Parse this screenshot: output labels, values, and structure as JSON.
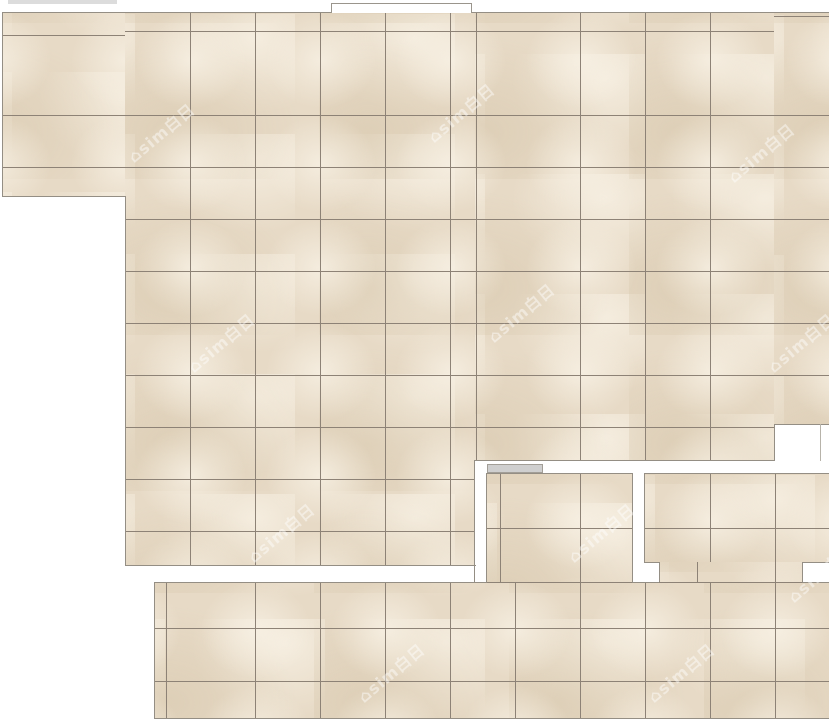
{
  "app": {
    "view_label": "tile-layout-floor-plan",
    "canvas_width": 829,
    "canvas_height": 723
  },
  "palette": {
    "background": "#ffffff",
    "tile_base": "#e7dac6",
    "grout": "#8d8276",
    "region_border": "#948e84",
    "vein_light": "rgba(247,240,227,0.85)",
    "vein_light_end": "rgba(247,240,227,0)",
    "vein_dark": "rgba(214,198,171,0.55)",
    "vein_dark_end": "rgba(214,198,171,0)",
    "threshold_fill": "#cfcfcf",
    "threshold_border": "#a29e97",
    "opening_border": "#9a958c",
    "notch_inner_line": "#b7b3aa",
    "artifact_strip": "#dcdcdc",
    "watermark_color": "rgba(255,255,255,0.45)"
  },
  "tile_spec": {
    "tile_width_px": 65,
    "tile_height_px": 52,
    "grout_px": 1
  },
  "regions": [
    {
      "id": "a1",
      "x": 2,
      "y": 13,
      "w": 123,
      "h": 184,
      "vx": 59,
      "h_pattern": "rep52",
      "hy": 51
    },
    {
      "id": "a2",
      "x": 125,
      "y": 13,
      "w": 350,
      "h": 552,
      "vx": 1,
      "h_pattern": "rep52",
      "hy": 51
    },
    {
      "id": "a3",
      "x": 475,
      "y": 13,
      "w": 299,
      "h": 448,
      "vx": 41,
      "h_pattern": "rep52",
      "hy": 51
    },
    {
      "id": "a4",
      "x": 774,
      "y": 13,
      "w": 55,
      "h": 411,
      "vx": 2,
      "h_pattern": "rep52",
      "hy": 51
    },
    {
      "id": "b",
      "x": 487,
      "y": 474,
      "w": 145,
      "h": 109,
      "vx": 29,
      "h_pattern": "line54",
      "hy": 0
    },
    {
      "id": "c1",
      "x": 645,
      "y": 474,
      "w": 184,
      "h": 88,
      "vx": 1,
      "h_pattern": "line54",
      "hy": 0
    },
    {
      "id": "c2",
      "x": 659,
      "y": 562,
      "w": 143,
      "h": 21,
      "vx": 52,
      "h_pattern": "none",
      "hy": 0
    },
    {
      "id": "d",
      "x": 155,
      "y": 583,
      "w": 674,
      "h": 136,
      "vx": 36,
      "h_pattern": "lines45_98",
      "hy": 0
    }
  ],
  "edges": [
    {
      "id": "a-top",
      "x": 2,
      "y": 12,
      "w": 827,
      "h": 1
    },
    {
      "id": "a-left",
      "x": 2,
      "y": 12,
      "w": 1,
      "h": 185
    },
    {
      "id": "wing-bottom",
      "x": 2,
      "y": 196,
      "w": 124,
      "h": 1
    },
    {
      "id": "a-left-lower",
      "x": 125,
      "y": 196,
      "w": 1,
      "h": 370
    },
    {
      "id": "a-bottom",
      "x": 125,
      "y": 565,
      "w": 351,
      "h": 1
    },
    {
      "id": "channel-left",
      "x": 474,
      "y": 460,
      "w": 1,
      "h": 123
    },
    {
      "id": "a-bottom-right",
      "x": 475,
      "y": 460,
      "w": 300,
      "h": 1
    },
    {
      "id": "notch-left",
      "x": 774,
      "y": 424,
      "w": 1,
      "h": 37
    },
    {
      "id": "notch-top",
      "x": 774,
      "y": 424,
      "w": 55,
      "h": 1
    },
    {
      "id": "notch-inner",
      "x": 820,
      "y": 424,
      "w": 1,
      "h": 37,
      "color_key": "notch_inner_line"
    },
    {
      "id": "b-left",
      "x": 486,
      "y": 473,
      "w": 1,
      "h": 110
    },
    {
      "id": "b-top",
      "x": 486,
      "y": 473,
      "w": 147,
      "h": 1
    },
    {
      "id": "b-right",
      "x": 632,
      "y": 473,
      "w": 1,
      "h": 110
    },
    {
      "id": "c-left",
      "x": 644,
      "y": 473,
      "w": 1,
      "h": 90
    },
    {
      "id": "c-top",
      "x": 644,
      "y": 473,
      "w": 185,
      "h": 1
    },
    {
      "id": "c-notch1-top",
      "x": 644,
      "y": 562,
      "w": 16,
      "h": 1
    },
    {
      "id": "c-notch1-right",
      "x": 659,
      "y": 562,
      "w": 1,
      "h": 21
    },
    {
      "id": "c-notch2-top",
      "x": 802,
      "y": 562,
      "w": 27,
      "h": 1
    },
    {
      "id": "c-notch2-left",
      "x": 802,
      "y": 562,
      "w": 1,
      "h": 21
    },
    {
      "id": "d-top-1",
      "x": 154,
      "y": 582,
      "w": 333,
      "h": 1
    },
    {
      "id": "d-top-2",
      "x": 632,
      "y": 582,
      "w": 28,
      "h": 1
    },
    {
      "id": "d-top-3",
      "x": 802,
      "y": 582,
      "w": 27,
      "h": 1
    },
    {
      "id": "bd-grout-1",
      "x": 487,
      "y": 582,
      "w": 145,
      "h": 1,
      "color_key": "grout"
    },
    {
      "id": "cd-grout-2",
      "x": 659,
      "y": 582,
      "w": 143,
      "h": 1,
      "color_key": "grout"
    },
    {
      "id": "d-left",
      "x": 154,
      "y": 583,
      "w": 1,
      "h": 136
    },
    {
      "id": "d-bottom",
      "x": 154,
      "y": 718,
      "w": 675,
      "h": 1
    },
    {
      "id": "opening-div-1",
      "x": 386,
      "y": 3,
      "w": 1,
      "h": 10,
      "color_key": "opening_border"
    },
    {
      "id": "opening-div-2",
      "x": 450,
      "y": 3,
      "w": 1,
      "h": 10,
      "color_key": "opening_border"
    },
    {
      "id": "artifact-strip",
      "x": 8,
      "y": 0,
      "w": 109,
      "h": 4,
      "color_key": "artifact_strip"
    }
  ],
  "objects": {
    "door_opening": {
      "label": "wall-opening",
      "x": 331,
      "y": 3,
      "w": 141,
      "h": 10
    },
    "threshold_bar": {
      "label": "door-threshold",
      "x": 487,
      "y": 464,
      "w": 56,
      "h": 9
    }
  },
  "watermark": {
    "text": "⌂sim白日",
    "readable_part": "sim",
    "positions": [
      {
        "x": 120,
        "y": 120
      },
      {
        "x": 420,
        "y": 100
      },
      {
        "x": 720,
        "y": 140
      },
      {
        "x": 180,
        "y": 330
      },
      {
        "x": 480,
        "y": 300
      },
      {
        "x": 760,
        "y": 330
      },
      {
        "x": 240,
        "y": 520
      },
      {
        "x": 560,
        "y": 520
      },
      {
        "x": 780,
        "y": 560
      },
      {
        "x": 350,
        "y": 660
      },
      {
        "x": 640,
        "y": 660
      }
    ]
  }
}
